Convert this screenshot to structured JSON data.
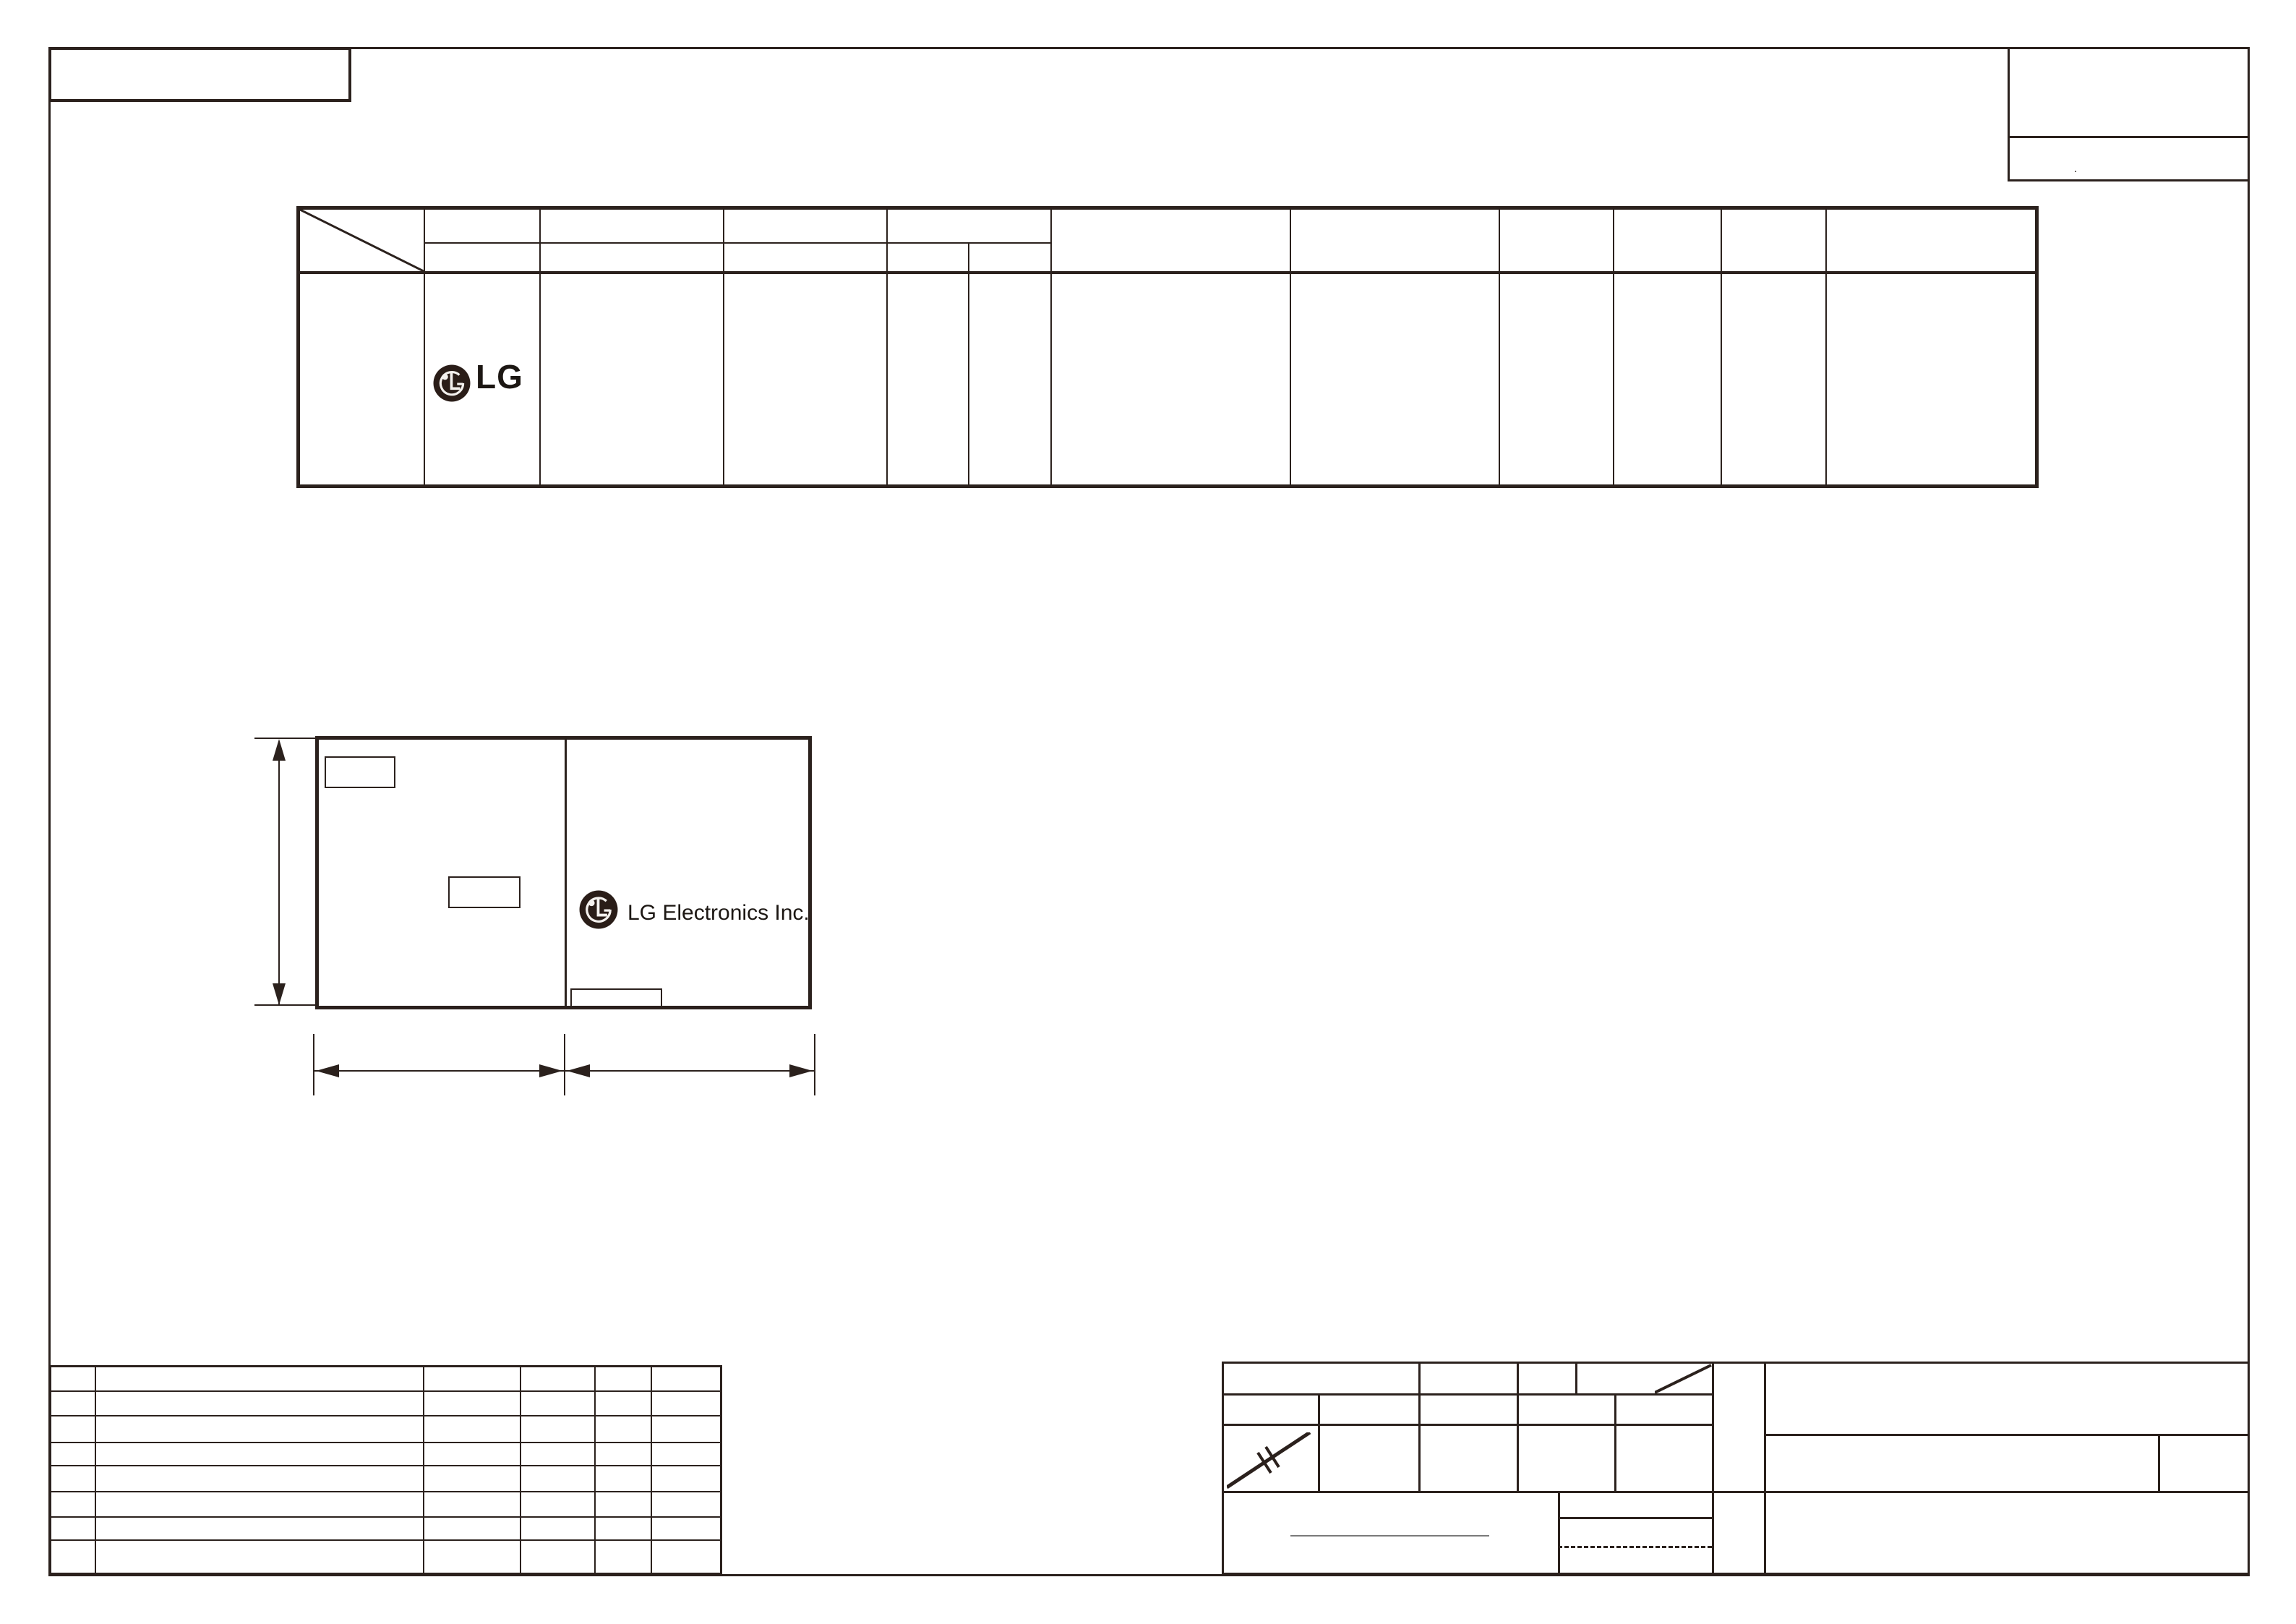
{
  "sheet": {
    "background": "#ffffff",
    "line_color": "#2b211d",
    "text_color": "#1c1713",
    "underline_color": "#7a7a7a"
  },
  "spec_table": {
    "logo_text": "LG",
    "logo_icon": "lg-emblem-icon"
  },
  "label_drawing": {
    "company_text": "LG Electronics Inc.",
    "logo_icon": "lg-emblem-icon"
  },
  "top_right_box": {
    "mark": "."
  }
}
